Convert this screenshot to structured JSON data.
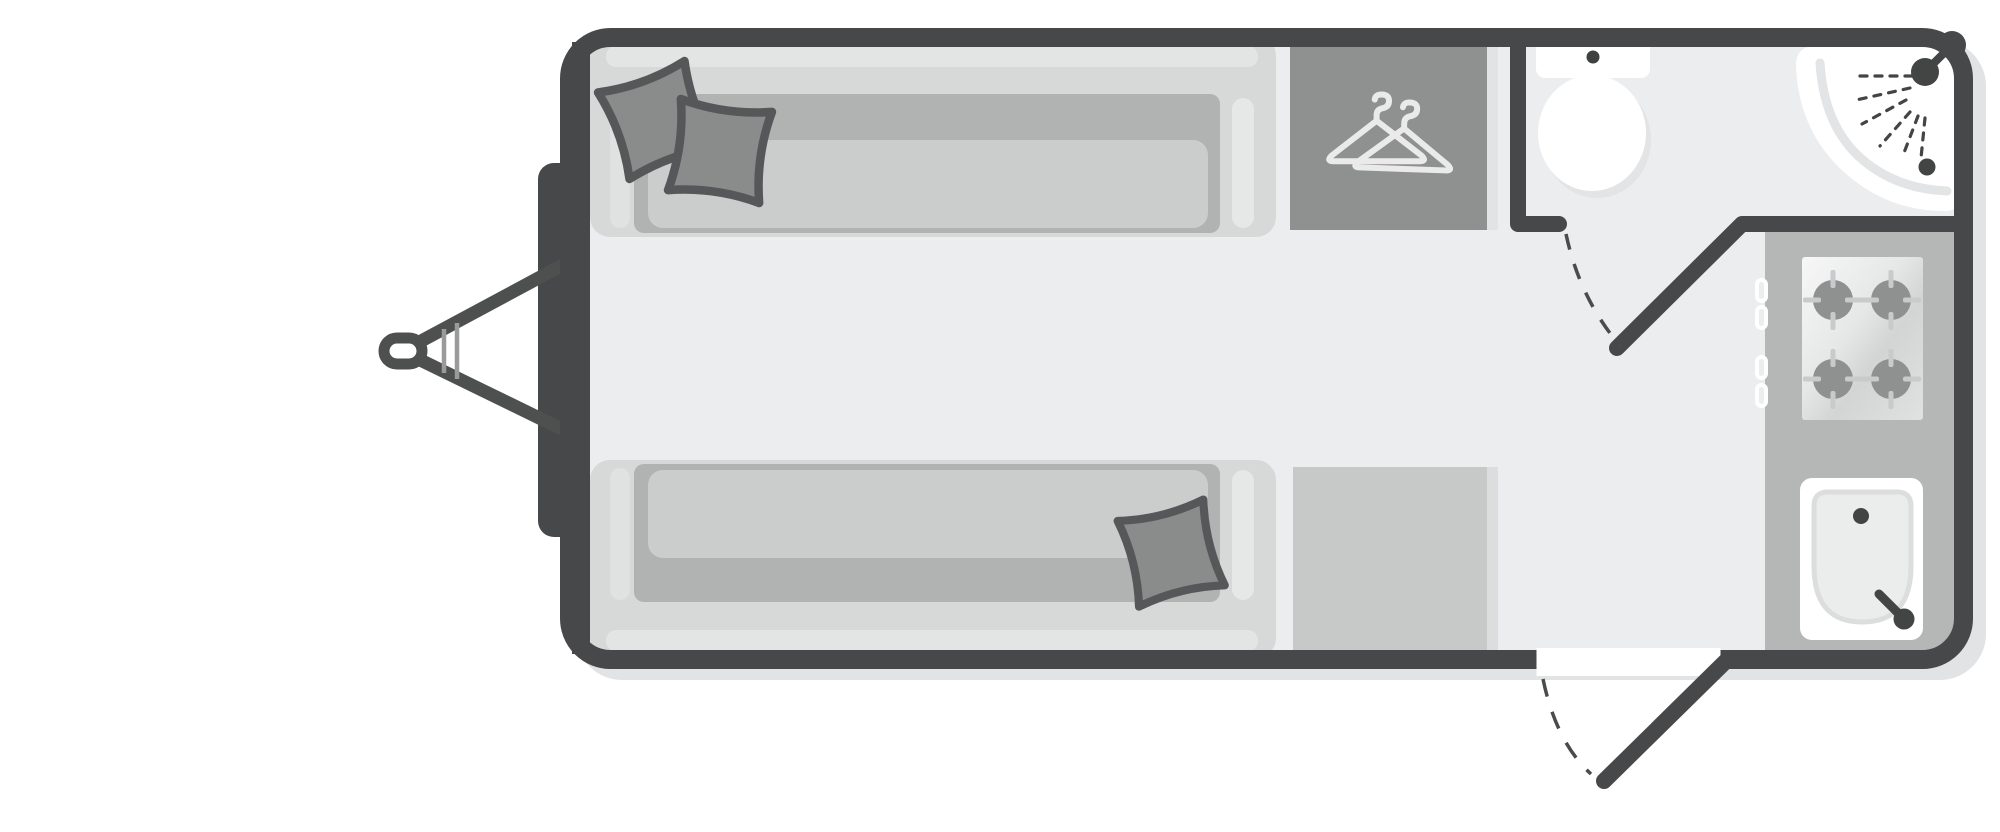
{
  "meta": {
    "title": "Caravan floor plan",
    "description": "Top-down floor plan of a two-berth touring caravan with front lounge, wardrobe, rear washroom and rear kitchen",
    "canvas_width": 2000,
    "canvas_height": 832,
    "background": "#ffffff"
  },
  "palette": {
    "wall": "#474849",
    "floor": "#ebedee",
    "body_shadow": "#e2e3e5",
    "furniture_base": "#d7d8d8",
    "furniture_trim": "#e3e4e4",
    "mattress": "#b1b2b2",
    "mattress_top": "#cbcccc",
    "pillow_fill": "#8a8b8b",
    "pillow_outline": "#565758",
    "wardrobe_fill": "#8f9090",
    "hanger_stroke": "#eaeaeb",
    "counter": "#b5b6b6",
    "cabinet": "#c7c8c8",
    "cabinet_side": "#dfe0e1",
    "fixture_white": "#ffffff",
    "fixture_detail": "#434444",
    "hob_burner": "#8f9090",
    "hob_tick": "#c9cacb"
  },
  "chassis": {
    "label": "A-frame drawbar with tow eye, jockey clamp and front gas locker",
    "parts": {
      "tow_eye": "Tow eye coupling",
      "drawbar": "A-frame drawbar",
      "jockey_clamp": "Jockey wheel clamp",
      "gas_locker": "Front gas locker"
    }
  },
  "rooms": {
    "lounge": {
      "label": "Front lounge with twin single beds",
      "beds": 2,
      "pillows": 3,
      "bed_top": {
        "label": "Single bed / sofa (top)",
        "pillows": 2
      },
      "bed_bottom": {
        "label": "Single bed / sofa (bottom)",
        "pillows": 1
      }
    },
    "wardrobe": {
      "label": "Wardrobe",
      "icon": "coat-hangers",
      "hangers": 2
    },
    "washroom": {
      "label": "Rear washroom",
      "toilet": "Toilet with cistern",
      "shower": "Corner shower tray with shower head, spray and drain",
      "door": "Hinged washroom door shown open with dashed swing arc"
    },
    "kitchen": {
      "label": "Rear kitchen",
      "hob": {
        "label": "Four-burner hob",
        "burners": 4,
        "knobs": 4
      },
      "sink": {
        "label": "Kitchen sink with tap and drain"
      },
      "cabinet": {
        "label": "Base cabinet unit beside entrance"
      }
    }
  },
  "doors": {
    "entry": {
      "label": "Entrance door shown open with dashed swing arc",
      "state": "open"
    },
    "washroom": {
      "label": "Washroom door shown open with dashed swing arc",
      "state": "open"
    }
  }
}
